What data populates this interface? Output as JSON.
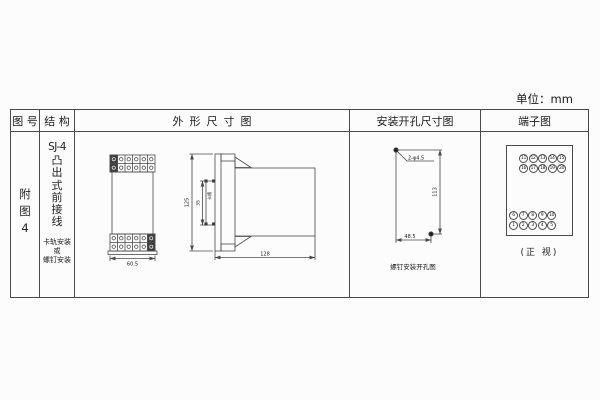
{
  "unit_label": "单位：mm",
  "table_headers": {
    "fig_no": "图 号",
    "structure": "结 构",
    "outline": "外形尺寸图",
    "mounting": "安装开孔尺寸图",
    "terminal": "端子图"
  },
  "fig_no": {
    "text": "附图4"
  },
  "structure": {
    "model": "SJ-4",
    "type_text": "凸出式前接线",
    "mount_notes": [
      "卡轨安装",
      "或",
      "螺钉安装"
    ]
  },
  "outline": {
    "front_width": "60.5",
    "side_height": "125",
    "notch_height": "35",
    "notch_label": "卡槽",
    "side_depth": "128"
  },
  "mounting": {
    "holes_label": "2-φ4.5",
    "vertical_dim": "113",
    "horizontal_dim": "48.5",
    "caption": "螺钉安装开孔图"
  },
  "terminal": {
    "top_rows": [
      [
        "11",
        "12",
        "13",
        "14",
        "15"
      ],
      [
        "16",
        "17",
        "18",
        "19",
        "20"
      ]
    ],
    "bottom_rows": [
      [
        "6",
        "7",
        "8",
        "9",
        "10"
      ],
      [
        "1",
        "2",
        "3",
        "4",
        "5"
      ]
    ],
    "caption": "(正 视)"
  },
  "colors": {
    "line": "#4a4a4a",
    "text": "#222222",
    "background": "#fcfcfc"
  }
}
